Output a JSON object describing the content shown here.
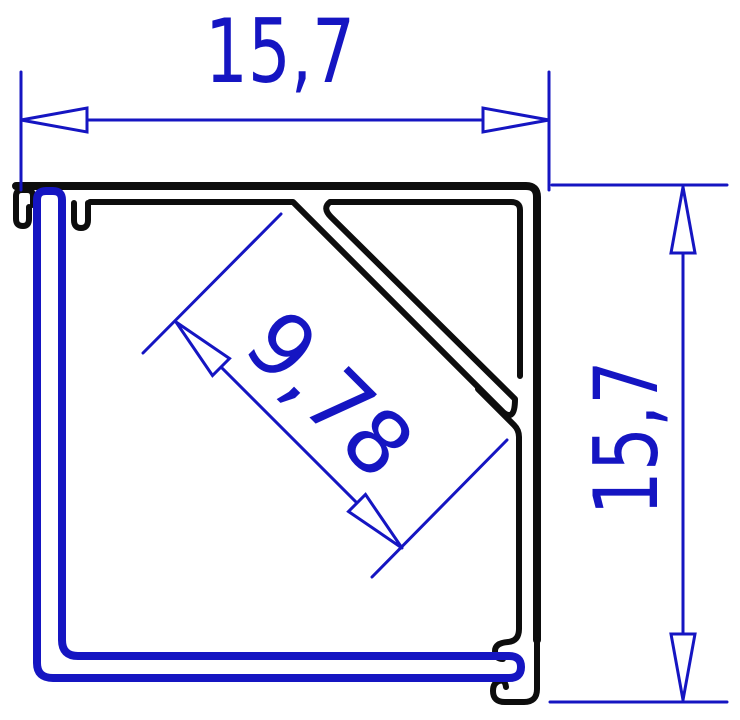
{
  "drawing": {
    "title": "Corner LED profile cross-section with dimensions",
    "dimension_width": "15,7",
    "dimension_height": "15,7",
    "dimension_channel": "9,78",
    "colors": {
      "dimension_blue": "#1515c2",
      "profile_black": "#0d0d0d",
      "cover_blue": "#1515c2",
      "background": "#ffffff",
      "arrow_fill": "#ffffff"
    }
  }
}
